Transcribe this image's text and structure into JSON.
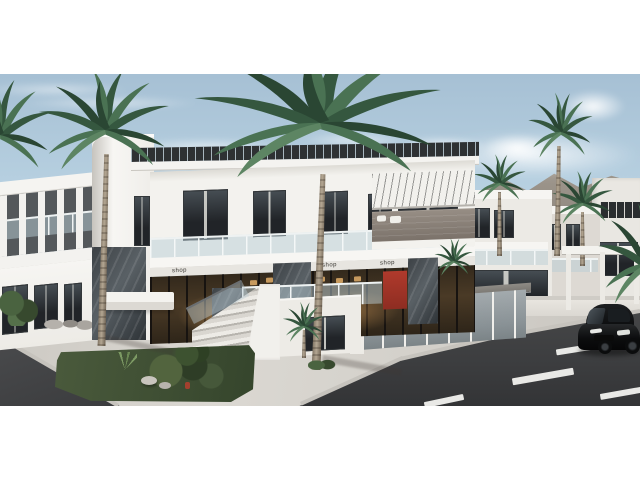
{
  "scene": {
    "kind": "3D architectural exterior render (letterboxed)",
    "subject": "Modern two-storey white mixed-use complex with rooftop louver pergola, glass balconies, warm-lit shopfronts, corner entrance stairs, landscaped island with palms, sidewalk plaza, asphalt streets with dashed lane lines and a black hatchback car; white villas, palms and hazy mountains in the background",
    "signs": {
      "shop_left": "shop",
      "shop_mid": "shop",
      "shop_right": "shop"
    },
    "palette": {
      "letterbox": "#ffffff",
      "sky_top": "#a6c0d4",
      "sky_horizon": "#e3edf3",
      "building_white": "#f3f2ee",
      "stone_cladding": "#424850",
      "pergola_slats": "#2e3133",
      "awning_stripes": "#f2f1ed",
      "asphalt": "#404143",
      "sidewalk": "#d6d3cd",
      "island_green": "#41512f",
      "palm_green": "#41664a",
      "accent_red": "#a33226",
      "car_black": "#0d0e10"
    },
    "objects": [
      "main-building",
      "left-wing",
      "corner-tower",
      "rooftop-pergola",
      "balcony-glass-railing",
      "shopfront-glass",
      "red-display-panel",
      "entrance-stairs",
      "annex-pavilion",
      "background-villas",
      "mountains",
      "palm-trees",
      "green-island",
      "stone-bench",
      "sidewalk-plaza",
      "left-road",
      "main-road",
      "lane-dashes",
      "black-car"
    ]
  }
}
